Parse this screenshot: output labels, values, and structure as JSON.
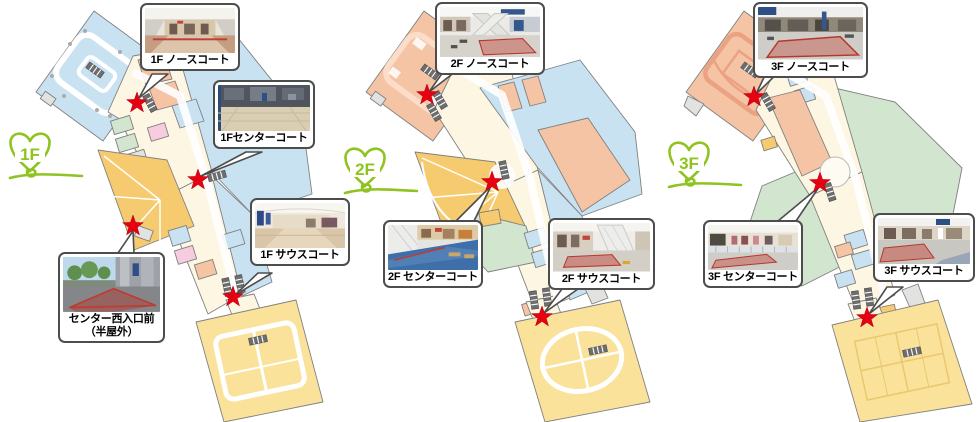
{
  "colors": {
    "map_blue": "#C9E2F2",
    "map_salmon": "#F4C4A4",
    "map_salmon_light": "#FAD9C4",
    "map_salmon_deep": "#EBA283",
    "map_yellow": "#FBE29B",
    "map_orange": "#F6CB70",
    "map_green": "#D2E5CF",
    "map_pink": "#F7CCDF",
    "map_cream": "#FCF6E2",
    "map_gray": "#E2E2E0",
    "map_outline": "#808080",
    "star_red": "#E60012",
    "logo_green": "#8FC31F",
    "callout_border": "#4D4D4D"
  },
  "floors": [
    {
      "label": "1F",
      "callouts": [
        {
          "label": "1F ノースコート",
          "photo": "mall-north-court-interior"
        },
        {
          "label": "1Fセンターコート",
          "photo": "mall-center-court-interior"
        },
        {
          "label": "1F サウスコート",
          "photo": "mall-south-court-interior"
        },
        {
          "label": "センター西入口前\n（半屋外）",
          "photo": "center-west-entrance-outdoor"
        }
      ]
    },
    {
      "label": "2F",
      "callouts": [
        {
          "label": "2F ノースコート",
          "photo": "mall-north-court-interior"
        },
        {
          "label": "2F センターコート",
          "photo": "mall-center-court-interior"
        },
        {
          "label": "2F サウスコート",
          "photo": "mall-south-court-interior"
        }
      ]
    },
    {
      "label": "3F",
      "callouts": [
        {
          "label": "3F ノースコート",
          "photo": "mall-north-court-interior"
        },
        {
          "label": "3F センターコート",
          "photo": "mall-center-court-interior"
        },
        {
          "label": "3F サウスコート",
          "photo": "mall-south-court-interior"
        }
      ]
    }
  ]
}
